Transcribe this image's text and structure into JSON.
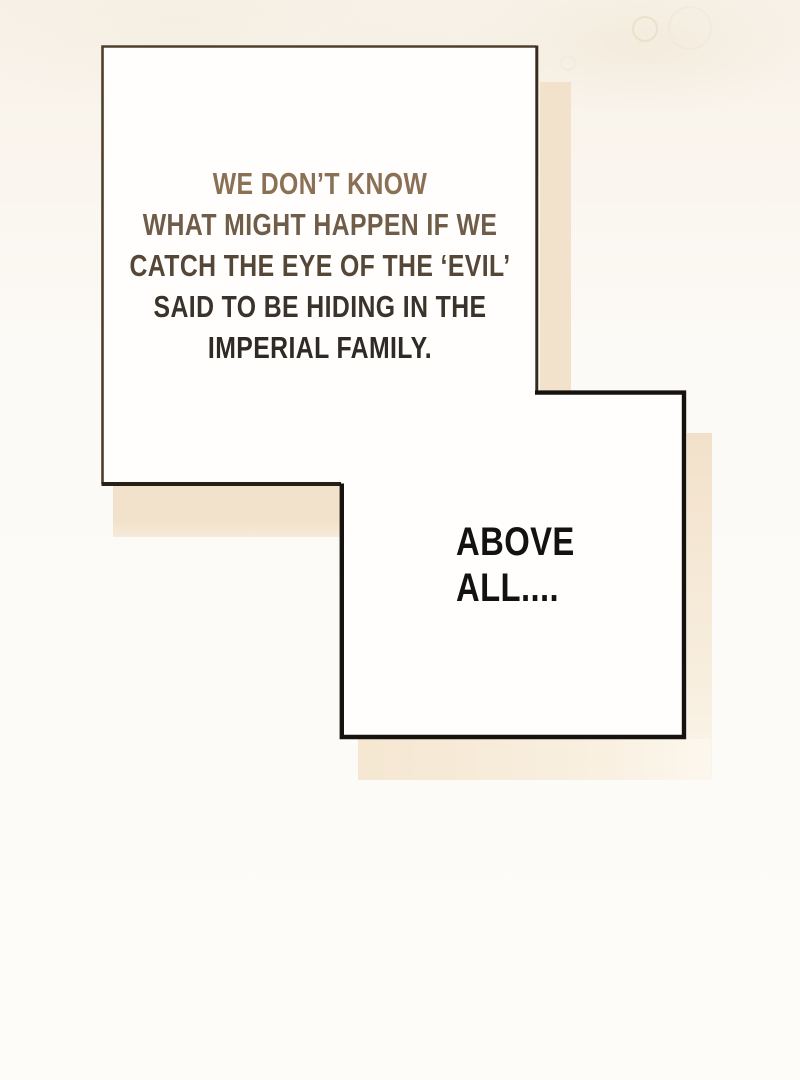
{
  "page": {
    "background_top_color": "#f7f1e8",
    "background_bottom_color": "#fdfcf9"
  },
  "speech_bubble_1": {
    "fill_color": "#fffefc",
    "border_color": "#4e3e2b",
    "border_color_right": "#372b1e",
    "border_color_bottom": "#262019",
    "shadow_color": "#f2e2cc",
    "lines": [
      {
        "text": "WE DON’T KNOW",
        "color": "#8a7156"
      },
      {
        "text": "WHAT MIGHT HAPPEN IF WE",
        "color": "#6f5d49"
      },
      {
        "text": "CATCH THE EYE OF THE ‘EVIL’",
        "color": "#554738"
      },
      {
        "text": "SAID TO BE HIDING IN THE",
        "color": "#3a332b"
      },
      {
        "text": "IMPERIAL FAMILY.",
        "color": "#2e2a25"
      }
    ]
  },
  "speech_bubble_2": {
    "fill_color": "#fffefd",
    "border_color": "#16130e",
    "shadow_color": "#f4e5cd",
    "lines": [
      {
        "text": "ABOVE",
        "color": "#141210"
      },
      {
        "text": "ALL....",
        "color": "#141210"
      }
    ]
  },
  "shadows": {
    "bubble1_right": {
      "color": "#f2e2cc"
    },
    "bubble1_bottom": {
      "color_top": "#f2e2cc",
      "color_bottom": "#f6ead8"
    },
    "bubble2_right": {
      "color_top": "#f2e1ca",
      "color_bottom": "#fbf5ea"
    },
    "bubble2_bottom": {
      "color_left": "#f5e7d1",
      "color_right": "#fcf7ee"
    }
  }
}
